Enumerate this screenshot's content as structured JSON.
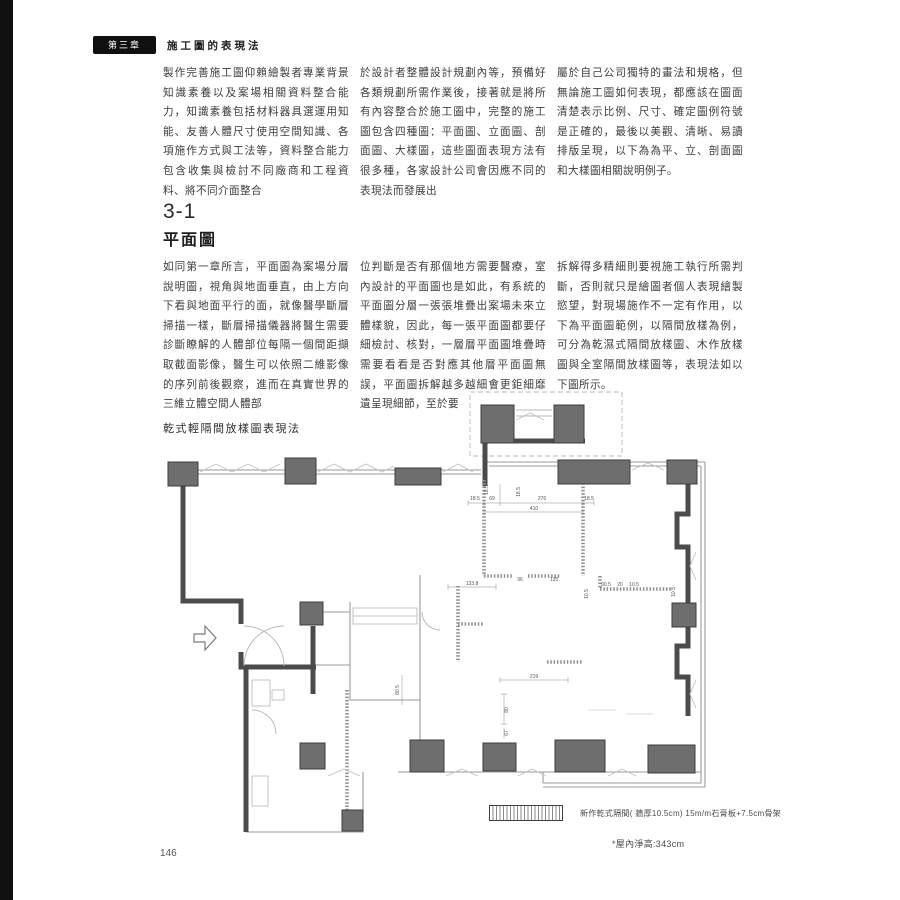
{
  "page": {
    "chapter_badge": "第三章",
    "chapter_title": "施工圖的表現法",
    "page_number": "146"
  },
  "intro": {
    "col1": "製作完善施工圖仰賴繪製者專業背景知識素養以及案場相關資料整合能力，知識素養包括材料器具選運用知能、友善人體尺寸使用空間知識、各項施作方式與工法等，資料整合能力包含收集與檢討不同廠商和工程資料、將不同介面整合",
    "col2": "於設計者整體設計規劃內等，預備好各類規劃所需作業後，接著就是將所有內容整合於施工圖中，完整的施工圖包含四種圖：平面圖、立面圖、剖面圖、大樣圖，這些圖面表現方法有很多種，各家設計公司會因應不同的表現法而發展出",
    "col3": "屬於自己公司獨特的畫法和規格，但無論施工圖如何表現，都應該在圖面清楚表示比例、尺寸、確定圖例符號是正確的，最後以美觀、清晰、易讀排版呈現，以下為為平、立、剖面圖和大樣圖相關說明例子。"
  },
  "section": {
    "number": "3-1",
    "title": "平面圖",
    "col1": "如同第一章所言，平面圖為案場分層說明圖，視角與地面垂直，由上方向下看與地面平行的面，就像醫學斷層掃描一樣，斷層掃描儀器將醫生需要診斷瞭解的人體部位每隔一個間距擷取截面影像，醫生可以依照二維影像的序列前後觀察，進而在真實世界的三維立體空間人體部",
    "col2": "位判斷是否有那個地方需要醫療，室內設計的平面圖也是如此，有系統的平面圖分層一張張堆疊出案場未來立體樣貌，因此，每一張平面圖都要仔細檢討、核對，一層層平面圖堆疊時需要看看是否對應其他層平面圖無誤，平面圖拆解越多越細會更鉅細靡遺呈現細節，至於要",
    "col3": "拆解得多精細則要視施工執行所需判斷，否則就只是繪圖者個人表現繪製慾望，對現場施作不一定有作用，以下為平面圖範例，以隔間放樣為例，可分為乾濕式隔間放樣圖、木作放樣圖與全室隔間放樣圖等，表現法如以下圖所示。"
  },
  "figure": {
    "label": "乾式輕隔間放樣圖表現法",
    "legend_text": "新作乾式隔間( 牆厚10.5cm)  15m/m石膏板+7.5cm骨架",
    "note": "*屋內淨高:343cm",
    "dims": [
      "18.5",
      "69",
      "276",
      "18.5",
      "410",
      "18.5",
      "96",
      "135",
      "133.8",
      "219",
      "80",
      "67",
      "80.5",
      "10.5",
      "90.5",
      "20",
      "10.5",
      "10.5",
      "18.5"
    ]
  },
  "colors": {
    "column_fill": "#6e6e6e",
    "wall_dark": "#4b4b4b",
    "wall_light": "#9a9a9a",
    "spine": "#101010"
  }
}
